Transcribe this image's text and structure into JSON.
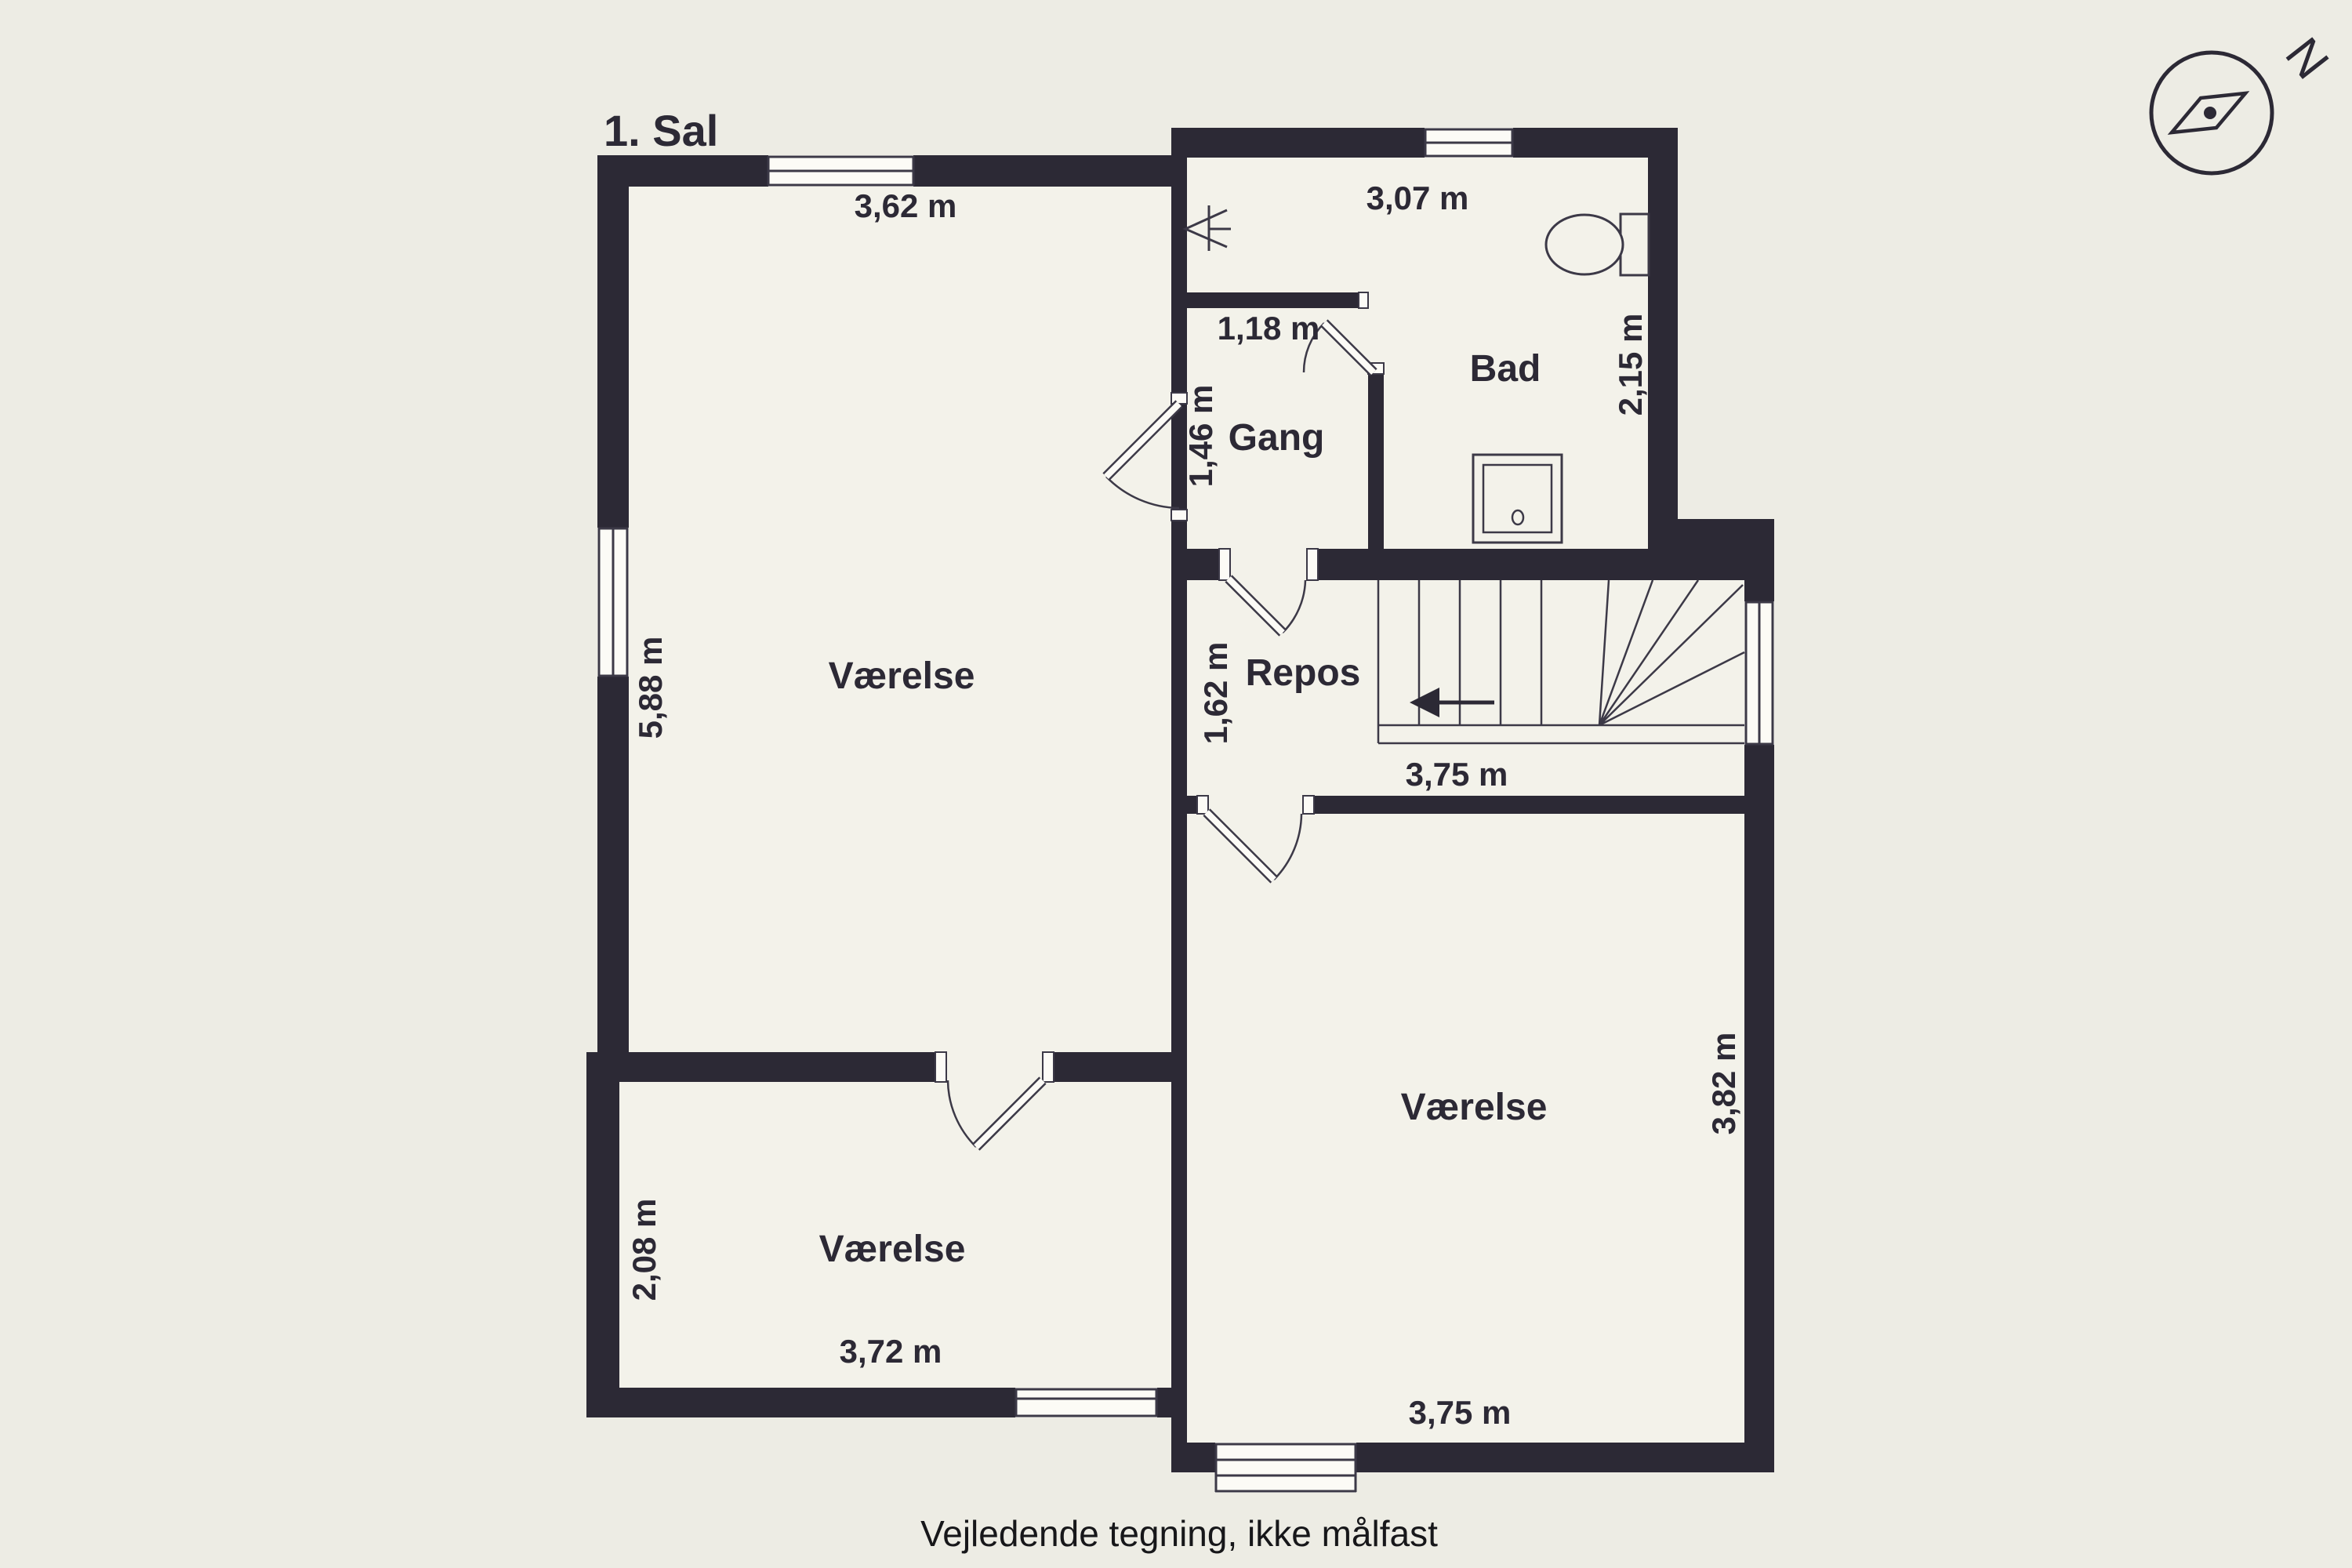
{
  "page": {
    "title": "1. Sal",
    "footer_note": "Vejledende tegning, ikke målfast",
    "compass_letter": "N"
  },
  "rooms": {
    "left": "Værelse",
    "bottom_left": "Værelse",
    "bottom_right": "Værelse",
    "bath": "Bad",
    "hall": "Gang",
    "landing": "Repos"
  },
  "dimensions": {
    "left_room_width": "3,62 m",
    "left_room_height": "5,88 m",
    "bath_width": "3,07 m",
    "bath_height": "2,15 m",
    "hall_width": "1,18 m",
    "hall_depth": "1,46 m",
    "landing_height": "1,62 m",
    "stairs_width": "3,75 m",
    "bottom_right_width": "3,75 m",
    "bottom_right_height": "3,82 m",
    "bottom_left_width": "3,72 m",
    "bottom_left_height": "2,08 m"
  },
  "icons": {
    "compass": "compass-rose",
    "toilet": "toilet",
    "sink": "sink",
    "shower": "shower",
    "stairs": "stairs-with-direction-arrow"
  },
  "colors": {
    "background": "#EDECE4",
    "floor": "#F3F2EA",
    "wall": "#2C2935",
    "line": "#3C3947",
    "text": "#2C2935",
    "window": "#FCFBF6"
  }
}
